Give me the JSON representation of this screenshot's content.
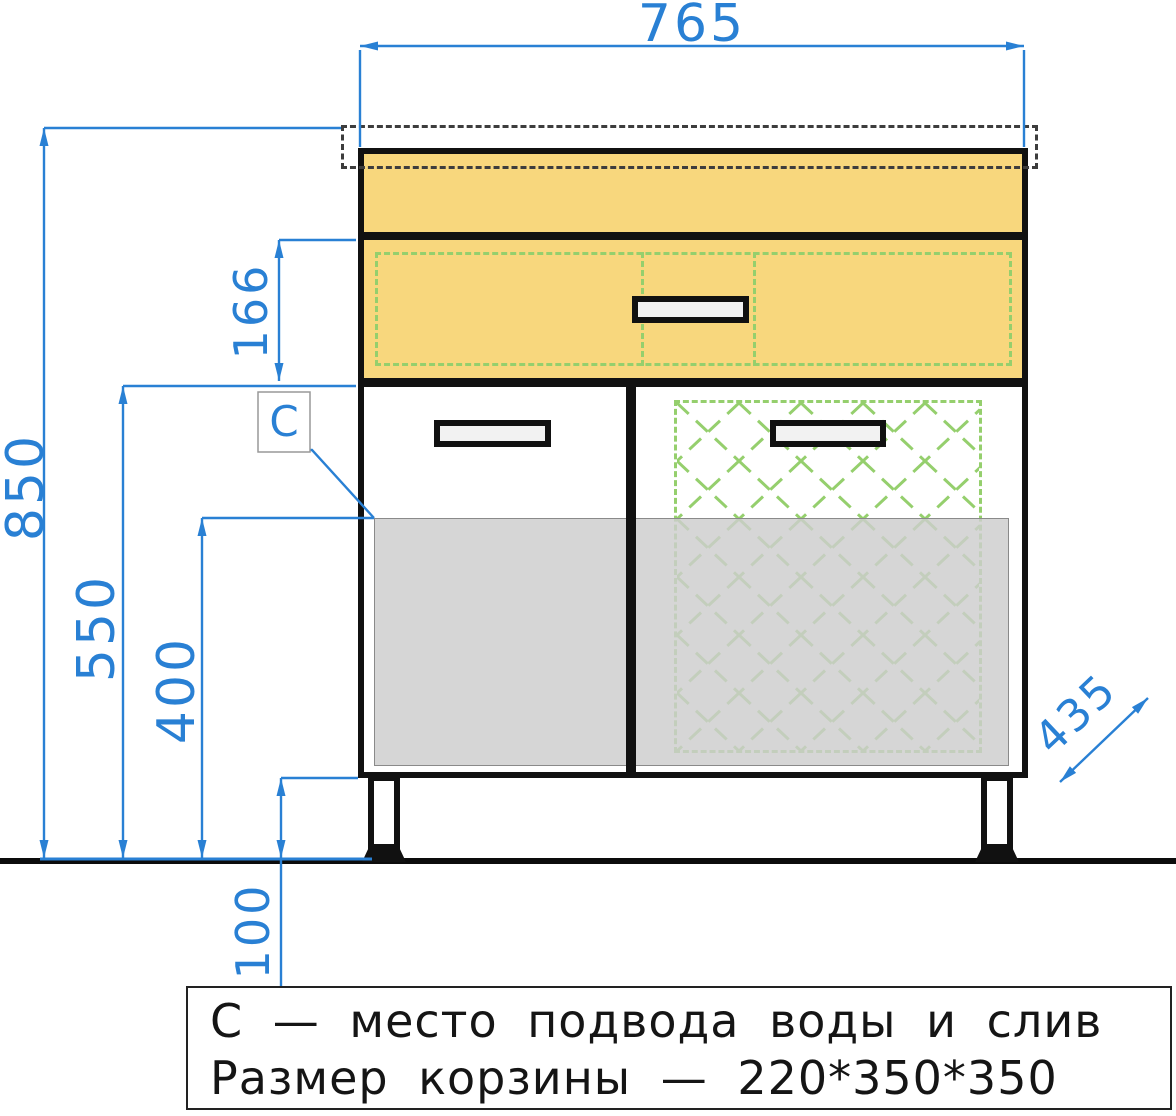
{
  "drawing": {
    "title_note": {
      "line1": "С — место подвода воды и слив",
      "line2": "Размер корзины — 220*350*350"
    },
    "dimensions": {
      "overall_width": {
        "value": "765"
      },
      "overall_height": {
        "value": "850"
      },
      "drawer_height": {
        "value": "166"
      },
      "carcass_height": {
        "value": "550"
      },
      "hookup_height": {
        "value": "400"
      },
      "leg_height": {
        "value": "100"
      },
      "depth": {
        "value": "435"
      },
      "marker": {
        "value": "C"
      }
    },
    "colors": {
      "dimension_blue": "#2980d4",
      "cabinet_yellow": "#f8d77d",
      "basket_green": "#95cf6d",
      "overlay_gray": "#cdcdcd",
      "outline_black": "#111111"
    }
  }
}
